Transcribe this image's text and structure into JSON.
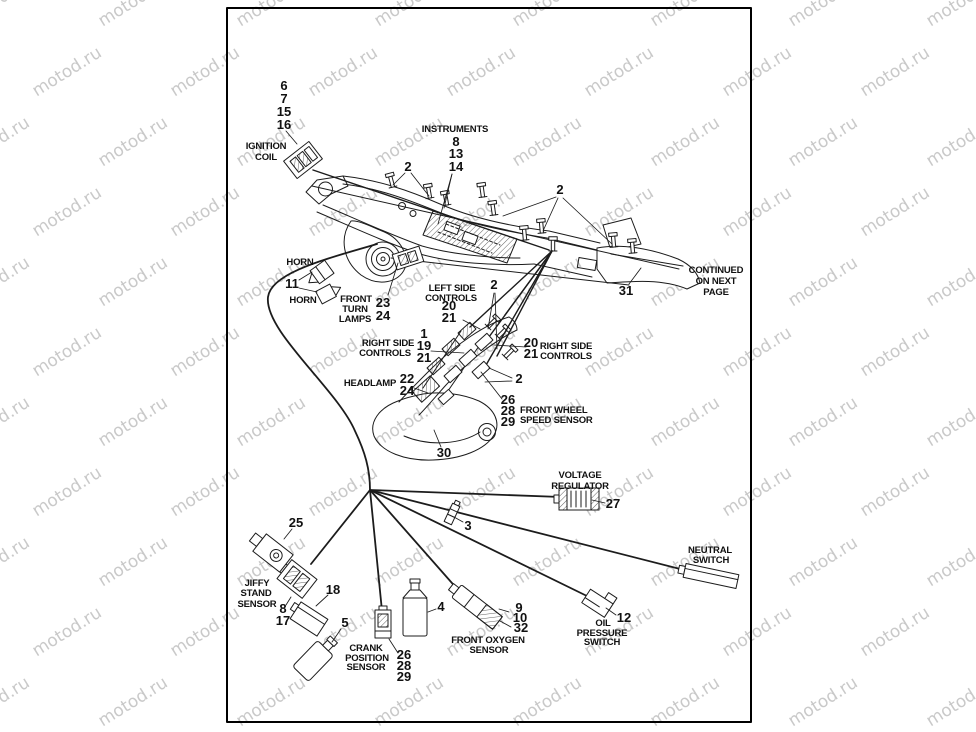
{
  "watermark": {
    "text": "motod.ru",
    "color": "#c9c9c9"
  },
  "page": {
    "bg": "#ffffff",
    "border_color": "#000000",
    "ink": "#1c1c1c"
  },
  "note": {
    "lines": [
      "CONTINUED",
      "ON NEXT",
      "PAGE"
    ]
  },
  "parts": {
    "ignition_coil": {
      "label": [
        "IGNITION",
        "COIL"
      ],
      "callouts": [
        "6",
        "7",
        "15",
        "16"
      ]
    },
    "instruments": {
      "label": "INSTRUMENTS",
      "callouts": [
        "8",
        "13",
        "14"
      ]
    },
    "cable_clip_a": {
      "callout": "2"
    },
    "cable_clip_b": {
      "callout": "2"
    },
    "cable_clip_c": {
      "callout": "2"
    },
    "cable_clip_d": {
      "callout": "2"
    },
    "horn": {
      "labels": [
        "HORN",
        "HORN"
      ],
      "callout": "11"
    },
    "front_turn_lamps": {
      "label": [
        "FRONT",
        "TURN",
        "LAMPS"
      ],
      "callouts": [
        "23",
        "24"
      ]
    },
    "left_side_controls": {
      "label": [
        "LEFT SIDE",
        "CONTROLS"
      ],
      "callouts": [
        "20",
        "21"
      ]
    },
    "right_side_controls_left": {
      "label": [
        "RIGHT SIDE",
        "CONTROLS"
      ],
      "callouts": [
        "1",
        "19",
        "21"
      ]
    },
    "right_side_controls_right": {
      "label": [
        "RIGHT SIDE",
        "CONTROLS"
      ],
      "callouts": [
        "20",
        "21"
      ]
    },
    "headlamp": {
      "label": "HEADLAMP",
      "callouts": [
        "22",
        "24"
      ]
    },
    "front_wheel_speed_sensor": {
      "label": [
        "FRONT WHEEL",
        "SPEED SENSOR"
      ],
      "callouts": [
        "26",
        "28",
        "29"
      ]
    },
    "front_end_assembly": {
      "callout": "30"
    },
    "frame_rear": {
      "callout": "31"
    },
    "voltage_regulator": {
      "label": [
        "VOLTAGE",
        "REGULATOR"
      ],
      "callout": "27"
    },
    "harness_connector": {
      "callout": "3"
    },
    "neutral_switch": {
      "label": [
        "NEUTRAL",
        "SWITCH"
      ]
    },
    "jiffy_stand_sensor": {
      "label": [
        "JIFFY",
        "STAND",
        "SENSOR"
      ],
      "callouts": [
        "8",
        "17"
      ]
    },
    "clamp_18": {
      "callout": "18"
    },
    "switch_25": {
      "callout": "25"
    },
    "bottle_5": {
      "callout": "5"
    },
    "bottle_4": {
      "callout": "4"
    },
    "crank_position_sensor": {
      "label": [
        "CRANK",
        "POSITION",
        "SENSOR"
      ],
      "callouts": [
        "26",
        "28",
        "29"
      ]
    },
    "front_oxygen_sensor": {
      "label": [
        "FRONT OXYGEN",
        "SENSOR"
      ],
      "callouts": [
        "9",
        "10",
        "32"
      ]
    },
    "oil_pressure_switch": {
      "label": [
        "OIL",
        "PRESSURE",
        "SWITCH"
      ],
      "callout": "12"
    }
  }
}
